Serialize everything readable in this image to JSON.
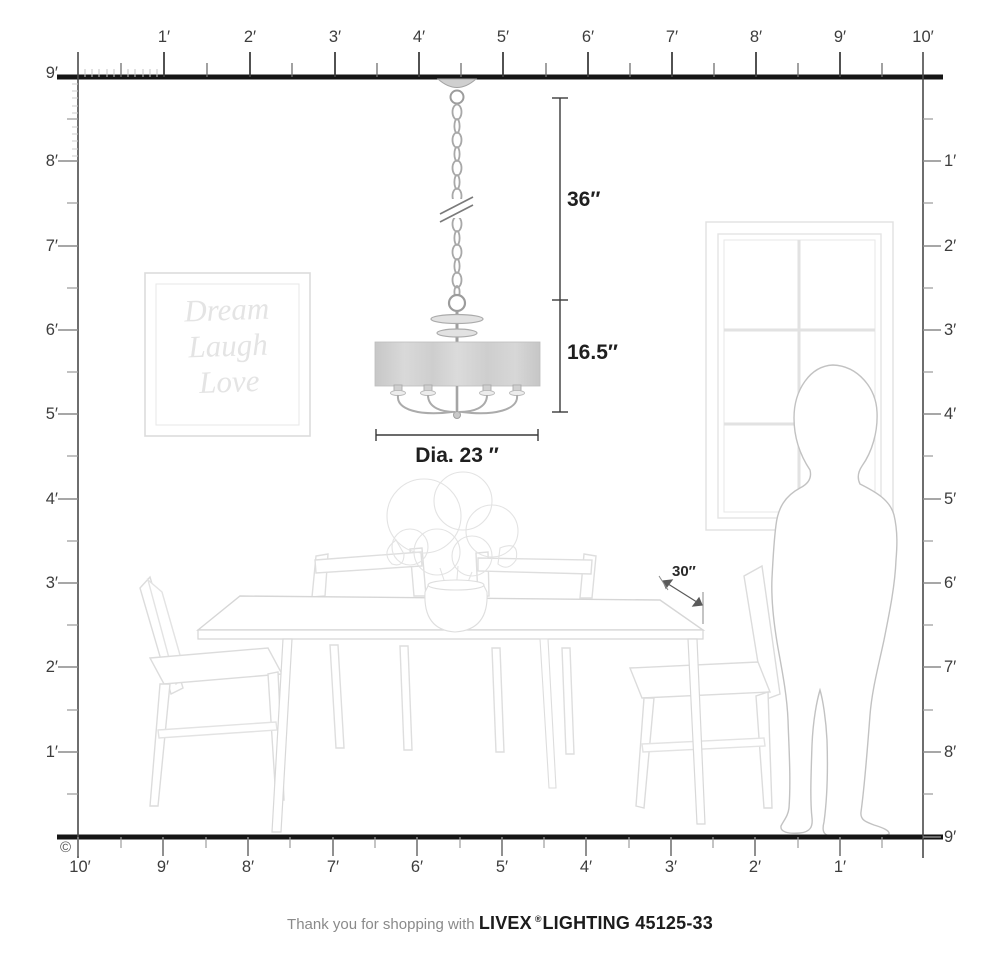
{
  "rulers": {
    "top": [
      "1′",
      "2′",
      "3′",
      "4′",
      "5′",
      "6′",
      "7′",
      "8′",
      "9′",
      "10′"
    ],
    "bottom": [
      "10′",
      "9′",
      "8′",
      "7′",
      "6′",
      "5′",
      "4′",
      "3′",
      "2′",
      "1′"
    ],
    "left": [
      "9′",
      "8′",
      "7′",
      "6′",
      "5′",
      "4′",
      "3′",
      "2′",
      "1′"
    ],
    "right": [
      "1′",
      "2′",
      "3′",
      "4′",
      "5′",
      "6′",
      "7′",
      "8′",
      "9′"
    ]
  },
  "dimensions": {
    "chain_length": "36″",
    "fixture_height": "16.5″",
    "diameter": "Dia. 23 ″",
    "table_depth": "30″"
  },
  "wall_art": {
    "line1": "Dream",
    "line2": "Laugh",
    "line3": "Love"
  },
  "footer": {
    "thanks": "Thank you for shopping with",
    "brand": "LIVEX",
    "reg": "®",
    "brand2": "LIGHTING 45125-33"
  },
  "copyright": "©",
  "colors": {
    "ruler_dark": "#3d3d3d",
    "structure_line": "#151515",
    "fixture_gray": "#a5a5a5",
    "shade_fill": "#d3d3d3",
    "art_gray": "#d9d9d9",
    "person_gray": "#c2c2c2"
  }
}
